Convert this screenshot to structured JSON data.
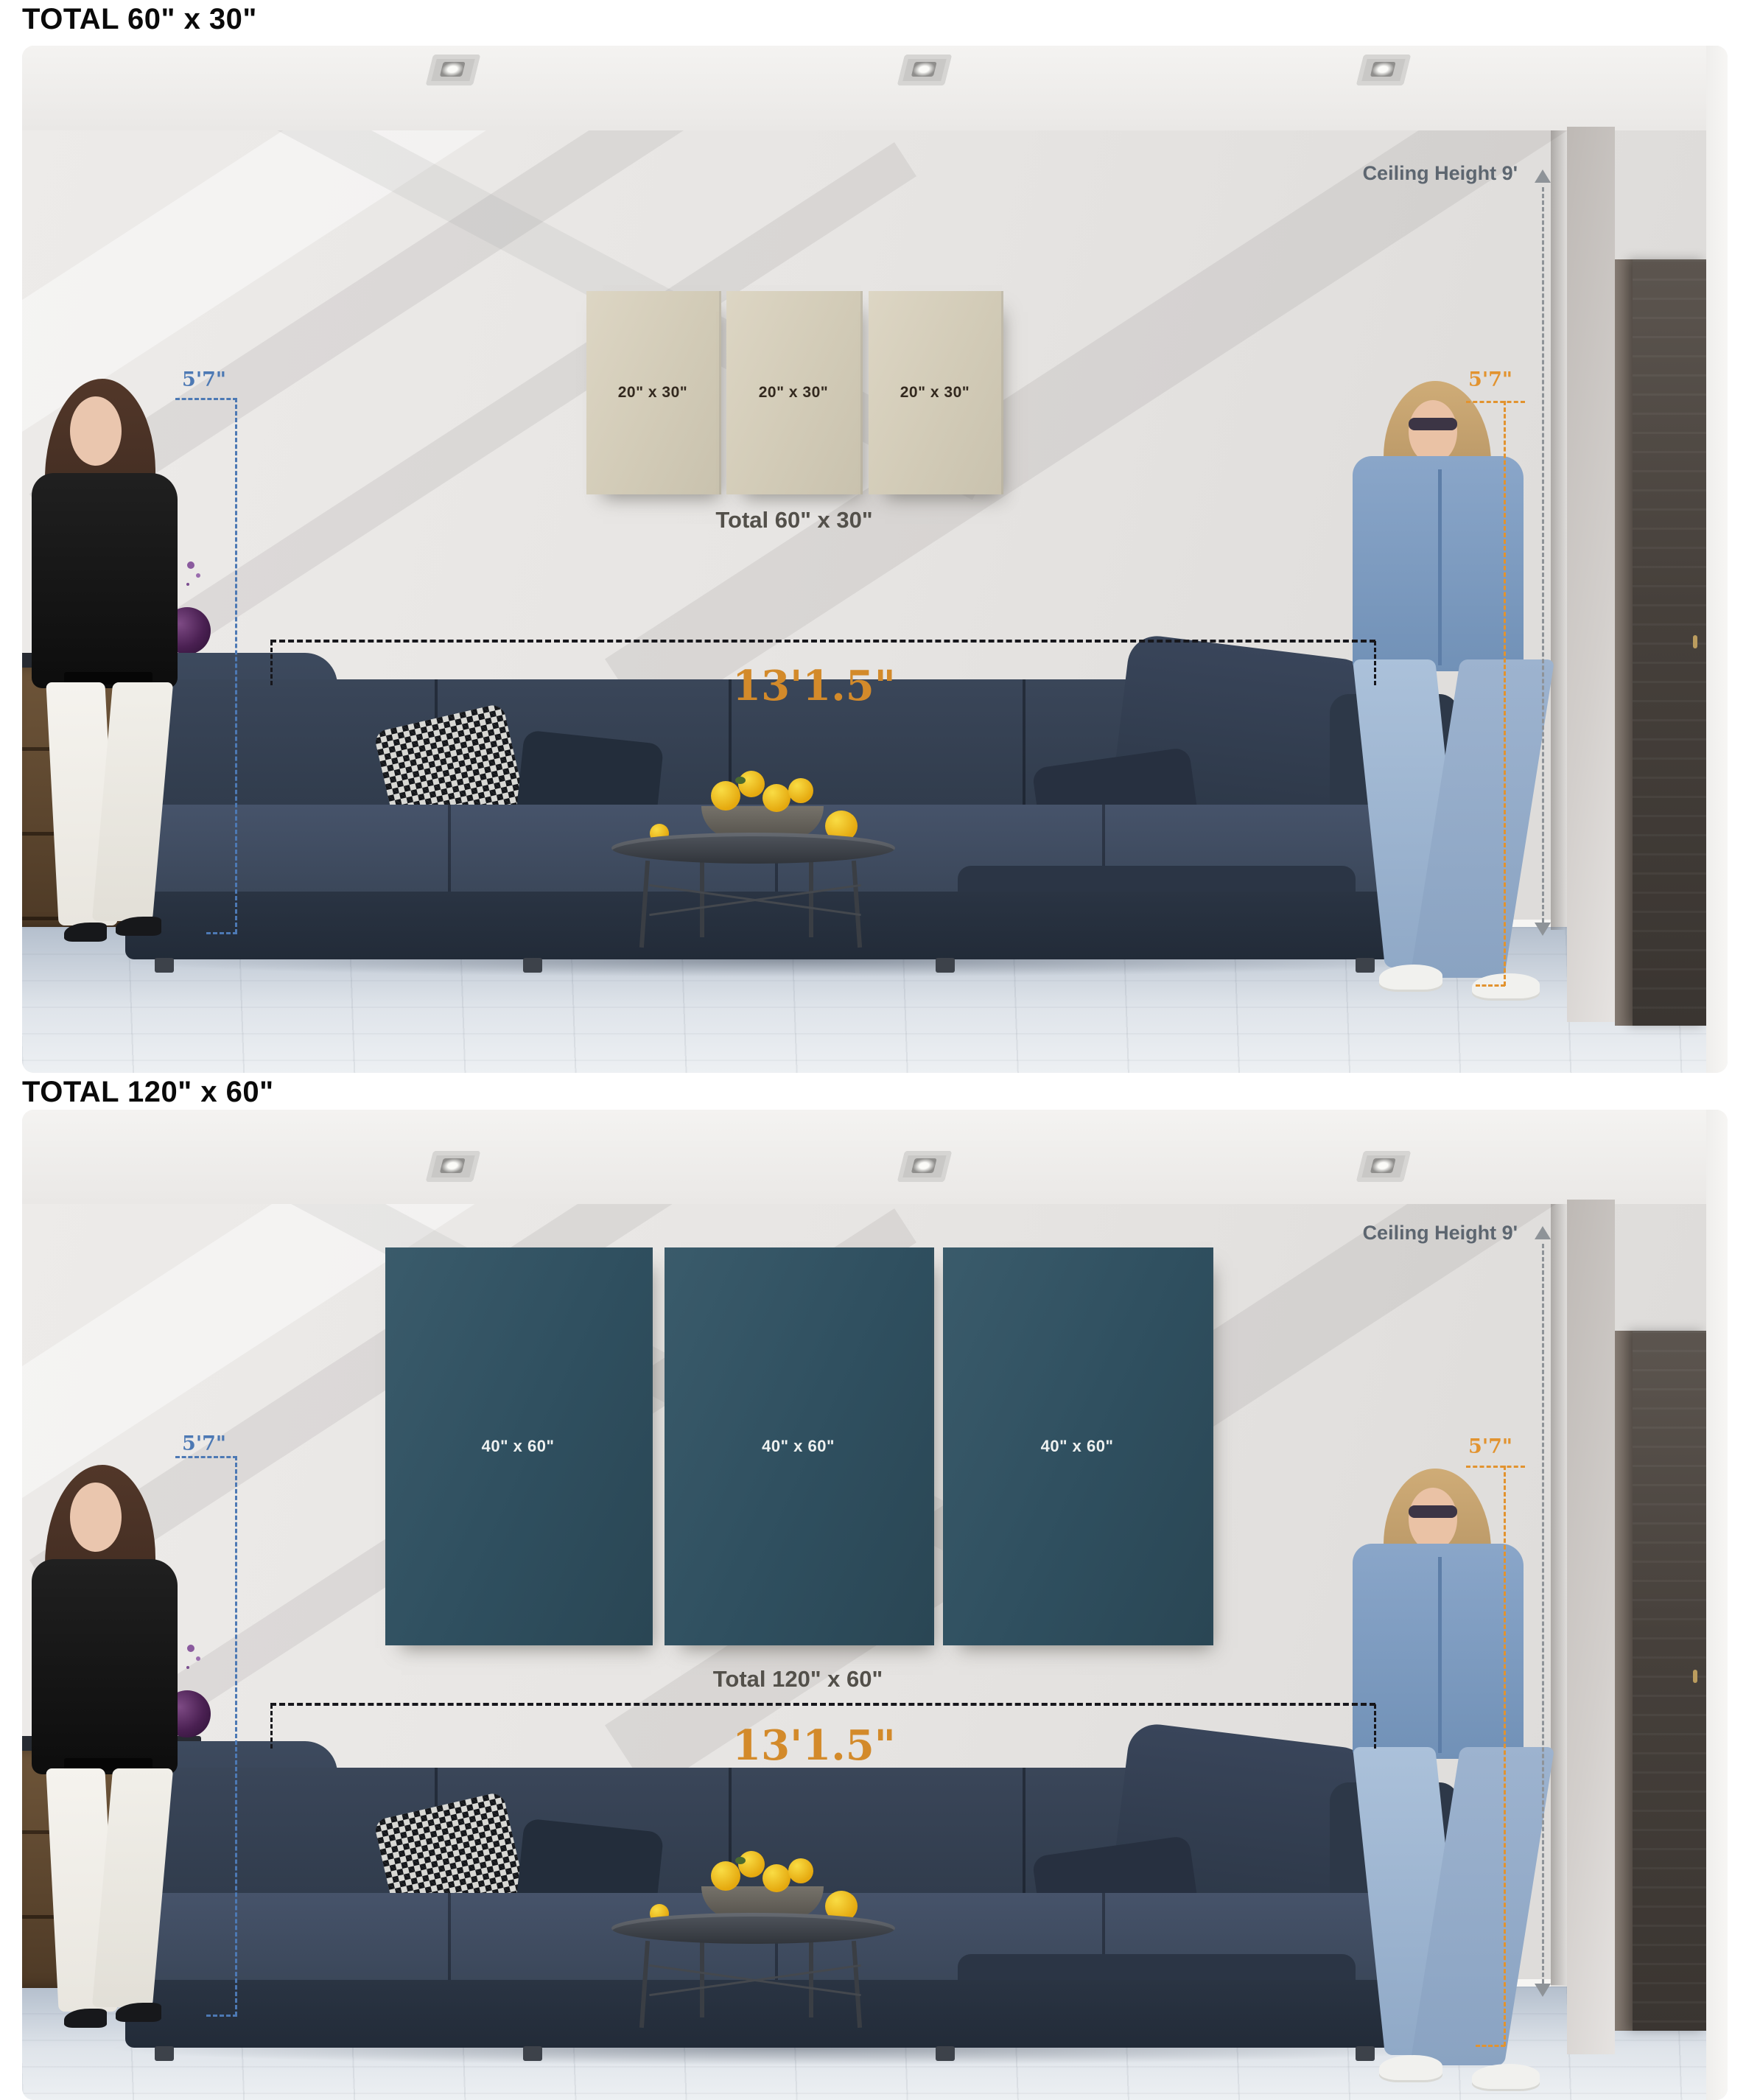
{
  "sections": [
    {
      "title": "TOTAL 60\" x 30\"",
      "ceiling_label": "Ceiling Height 9'",
      "left_person_height": "5'7\"",
      "right_person_height": "5'7\"",
      "sofa_width_label": "13'1.5\"",
      "panels": [
        {
          "label": "20\" x 30\""
        },
        {
          "label": "20\" x 30\""
        },
        {
          "label": "20\" x 30\""
        }
      ],
      "total_label": "Total 60\" x 30\""
    },
    {
      "title": "TOTAL 120\" x 60\"",
      "ceiling_label": "Ceiling Height 9'",
      "left_person_height": "5'7\"",
      "right_person_height": "5'7\"",
      "sofa_width_label": "13'1.5\"",
      "panels": [
        {
          "label": "40\" x 60\""
        },
        {
          "label": "40\" x 60\""
        },
        {
          "label": "40\" x 60\""
        }
      ],
      "total_label": "Total 120\" x 60\""
    }
  ],
  "colors": {
    "annotation_blue": "#4d79b4",
    "annotation_orange": "#e2932f",
    "dimension_orange": "#d38a2a",
    "ceiling_note_gray": "#5d6670",
    "canvas_beige": "#d6cfbb",
    "canvas_teal": "#315061",
    "sofa_navy": "#333e4e",
    "title_black": "#0a0a0a"
  }
}
